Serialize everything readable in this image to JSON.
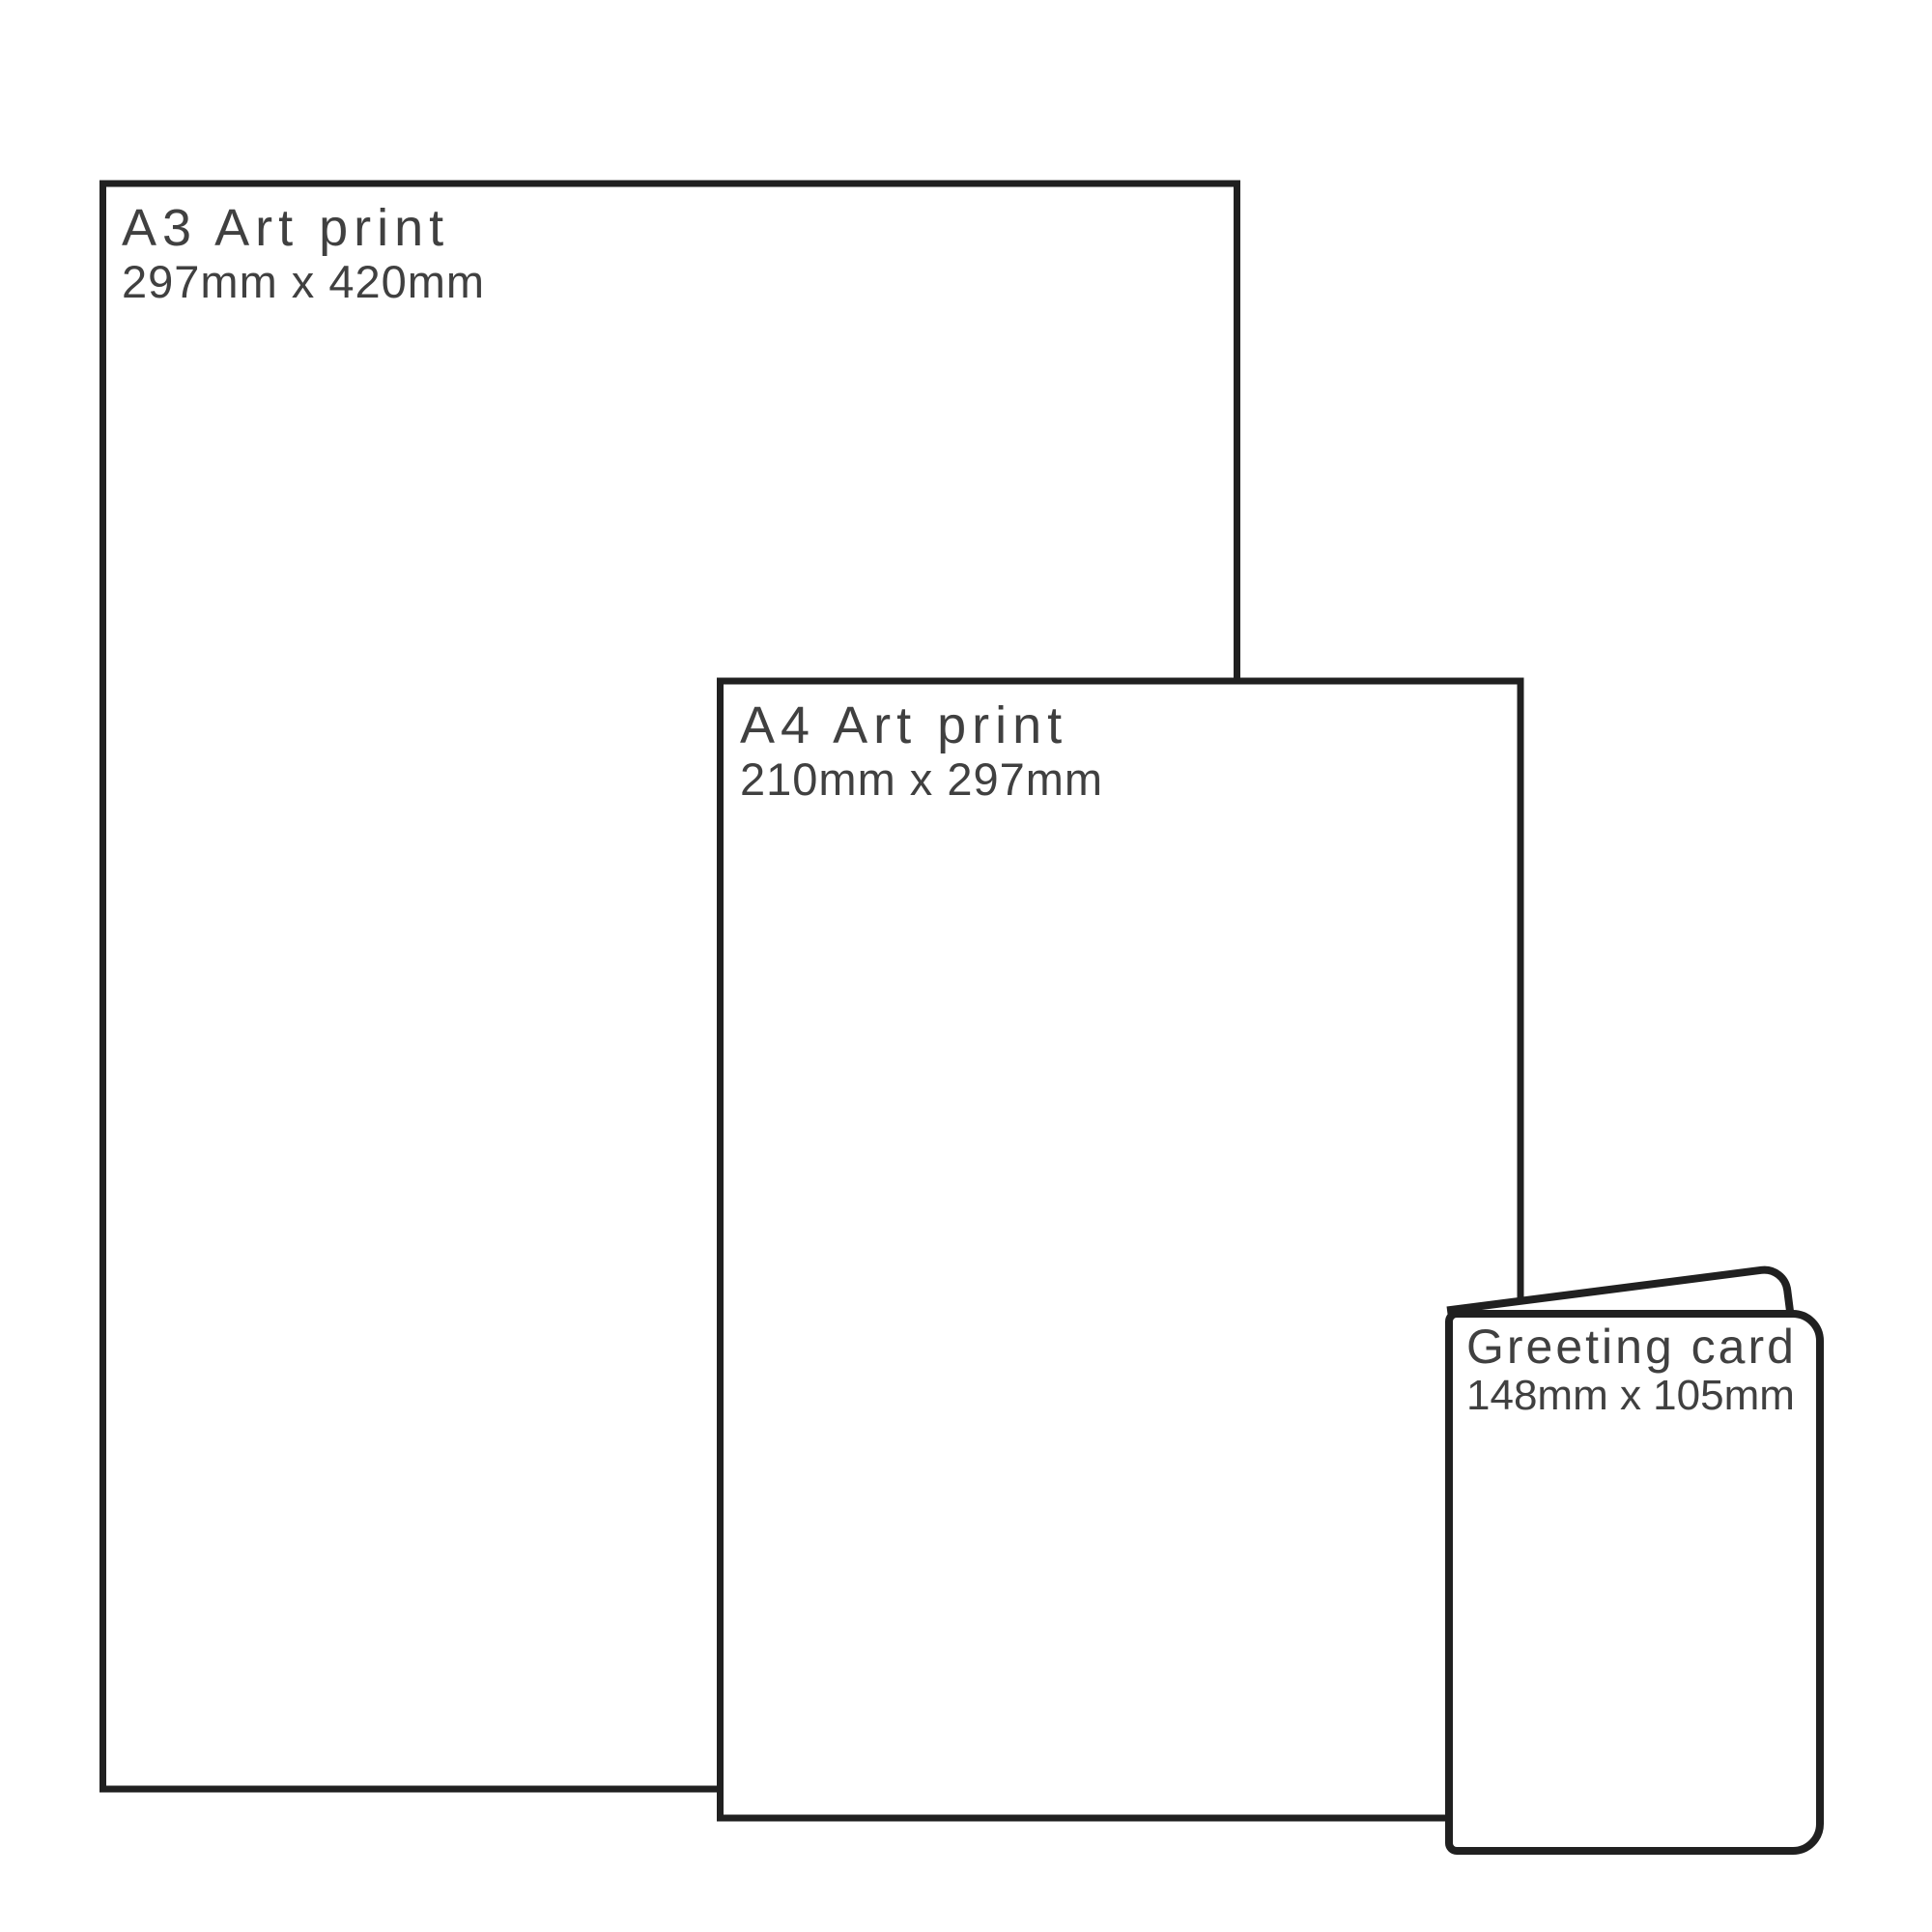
{
  "theme": {
    "bg": "#ffffff",
    "stroke": "#202020",
    "text": "#404040"
  },
  "diagram": {
    "kind": "print-size-comparison"
  },
  "items": [
    {
      "id": "a3-print",
      "title": "A3 Art print",
      "size": "297mm x 420mm"
    },
    {
      "id": "a4-print",
      "title": "A4 Art print",
      "size": "210mm x 297mm"
    },
    {
      "id": "greeting-card",
      "title": "Greeting card",
      "size": "148mm x 105mm"
    }
  ]
}
